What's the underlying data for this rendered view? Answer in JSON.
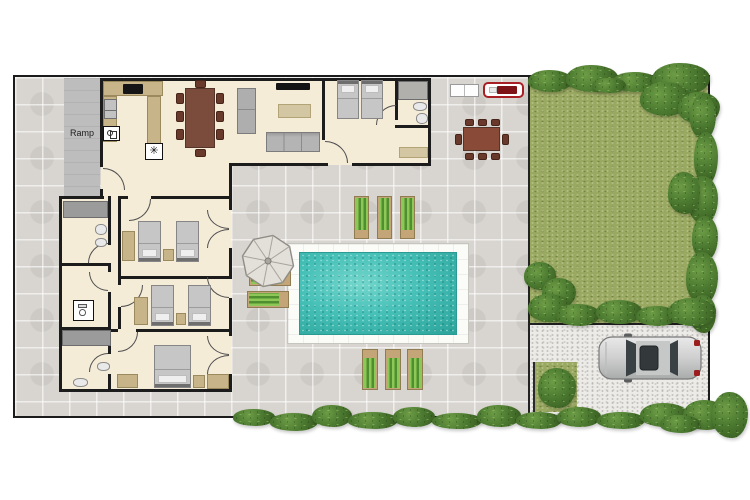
{
  "scene": {
    "type": "floor-plan",
    "description": "Top-down floor plan of a single-storey villa with swimming pool, paved patio, lawn garden, gravel driveway and parked car"
  },
  "labels": {
    "ramp": "Ramp"
  },
  "icons": {
    "freezer": "✳"
  },
  "areas": [
    "patio",
    "ramp",
    "lawn-garden",
    "driveway",
    "pool",
    "pool-deck",
    "lawn-patch"
  ],
  "rooms": [
    {
      "name": "kitchen",
      "features": [
        "l-counter",
        "cooktop",
        "sink",
        "stove",
        "freezer"
      ]
    },
    {
      "name": "dining-area",
      "features": [
        "table-for-8"
      ]
    },
    {
      "name": "living-room",
      "features": [
        "tv",
        "two-sofas",
        "coffee-table"
      ]
    },
    {
      "name": "bedroom-1",
      "beds": "2 twin",
      "features": [
        "ensuite-bathroom",
        "rug"
      ]
    },
    {
      "name": "bedroom-2",
      "beds": "2 twin",
      "features": [
        "wardrobe",
        "nightstand",
        "patio-doors"
      ]
    },
    {
      "name": "bedroom-3",
      "beds": "2 twin",
      "features": [
        "wardrobe",
        "nightstand",
        "patio-door"
      ]
    },
    {
      "name": "bedroom-4",
      "beds": "1 double",
      "features": [
        "wardrobes",
        "nightstand",
        "patio-doors"
      ]
    },
    {
      "name": "bathroom-1-ensuite",
      "features": [
        "shower",
        "sink",
        "toilet"
      ]
    },
    {
      "name": "bathroom-2",
      "features": [
        "shower",
        "toilet",
        "sink"
      ]
    },
    {
      "name": "wc",
      "features": [
        "toilet"
      ]
    },
    {
      "name": "bathroom-3",
      "features": [
        "shower",
        "sink",
        "toilet"
      ]
    }
  ],
  "outdoor": {
    "sun_loungers_total": 8,
    "loungers_above_pool": 3,
    "loungers_below_pool": 3,
    "loungers_at_umbrella": 2,
    "umbrella": 1,
    "outdoor_dining_seats": 8,
    "bbq_grill": 1,
    "white_bench": 1,
    "parked_cars": 1,
    "garden_bush_patch": 1
  },
  "colors": {
    "plot_border": "#1b1b1b",
    "patio_stone": "#d8d5d0",
    "house_floor": "#f5ecd8",
    "wall": "#1c1c1c",
    "ramp_gray": "#bdbdbd",
    "lawn_green": "#9aa961",
    "hedge_green": "#4d7b31",
    "driveway_gravel": "#edebe7",
    "pool_water_teal": "#45c0b7",
    "pool_deck_white": "#fbfbf8",
    "lounger_green": "#8cc757",
    "counter_tan": "#c7b489",
    "dining_table_brown": "#7b4c3c",
    "sofa_gray": "#aeaeae",
    "car_silver": "#cfcfcf",
    "bbq_red": "#a82025"
  }
}
